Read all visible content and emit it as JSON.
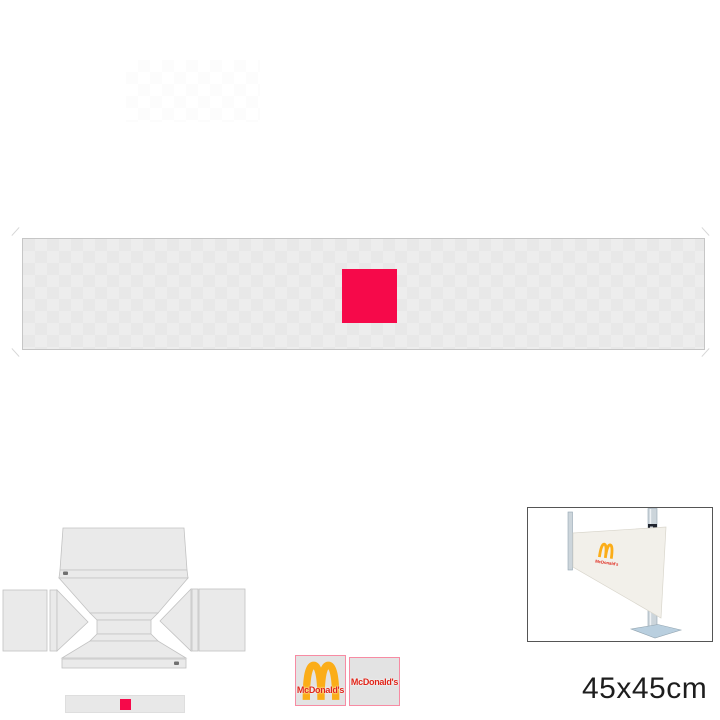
{
  "colors": {
    "accent_red": "#f6094a",
    "banner_fill": "#e8e8e8",
    "banner_checker": "#ededed",
    "banner_border": "#c6c6c6",
    "faint_square": "#fcfcfc",
    "template_fill": "#eaeaea",
    "template_stroke": "#c2c2c2",
    "marker_dark": "#5a5a5a",
    "swatch_bg": "#e3e3e3",
    "swatch_border": "#f78ba3",
    "mcd_red": "#df2418",
    "mcd_gold": "#fbad18",
    "photo_border": "#555555",
    "pole_fill": "#ccd5db",
    "pole_edge": "#93a5b1",
    "pole_dark_fitting": "#20242e",
    "foot_fill": "#b9cfdf",
    "cloth_fill": "#f2f0ea",
    "cloth_edge": "#d9d6cc",
    "text_dark": "#1d1d1d"
  },
  "swatches": [
    {
      "text": "McDonald's"
    },
    {
      "text": "McDonald's"
    }
  ],
  "photo": {
    "logo_text": "McDonald's"
  },
  "size_label": "45x45cm"
}
